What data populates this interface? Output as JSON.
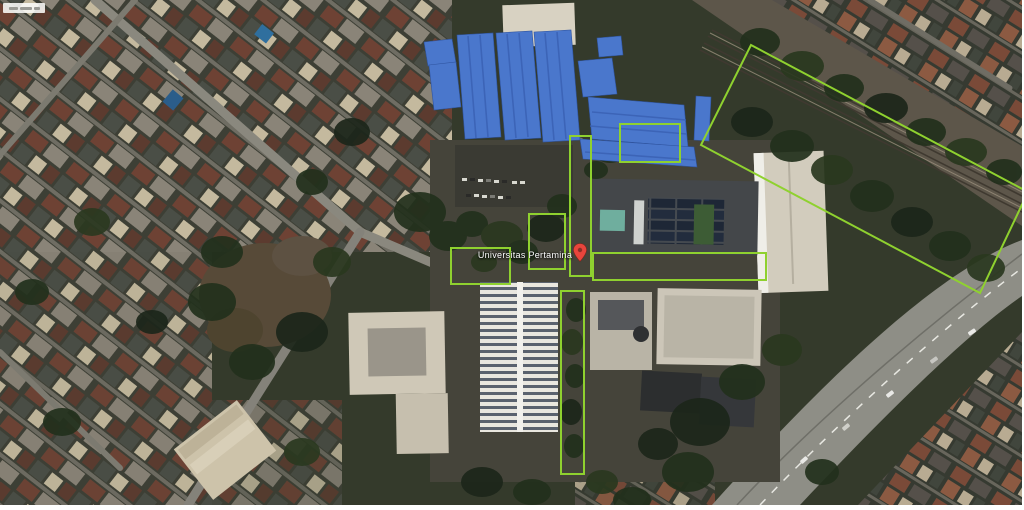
{
  "map": {
    "place_label": "Universitas Pertamina",
    "colors": {
      "annotation_green": "#8fd12f",
      "building_highlight_blue": "#4a77cc",
      "building_highlight_blue_dark": "#3a61b4",
      "pin_red": "#e8453c",
      "pin_red_dark": "#8c2f27"
    },
    "annotations": {
      "green_boxes_count": 7,
      "blue_highlighted_roofs_count": 10
    }
  }
}
